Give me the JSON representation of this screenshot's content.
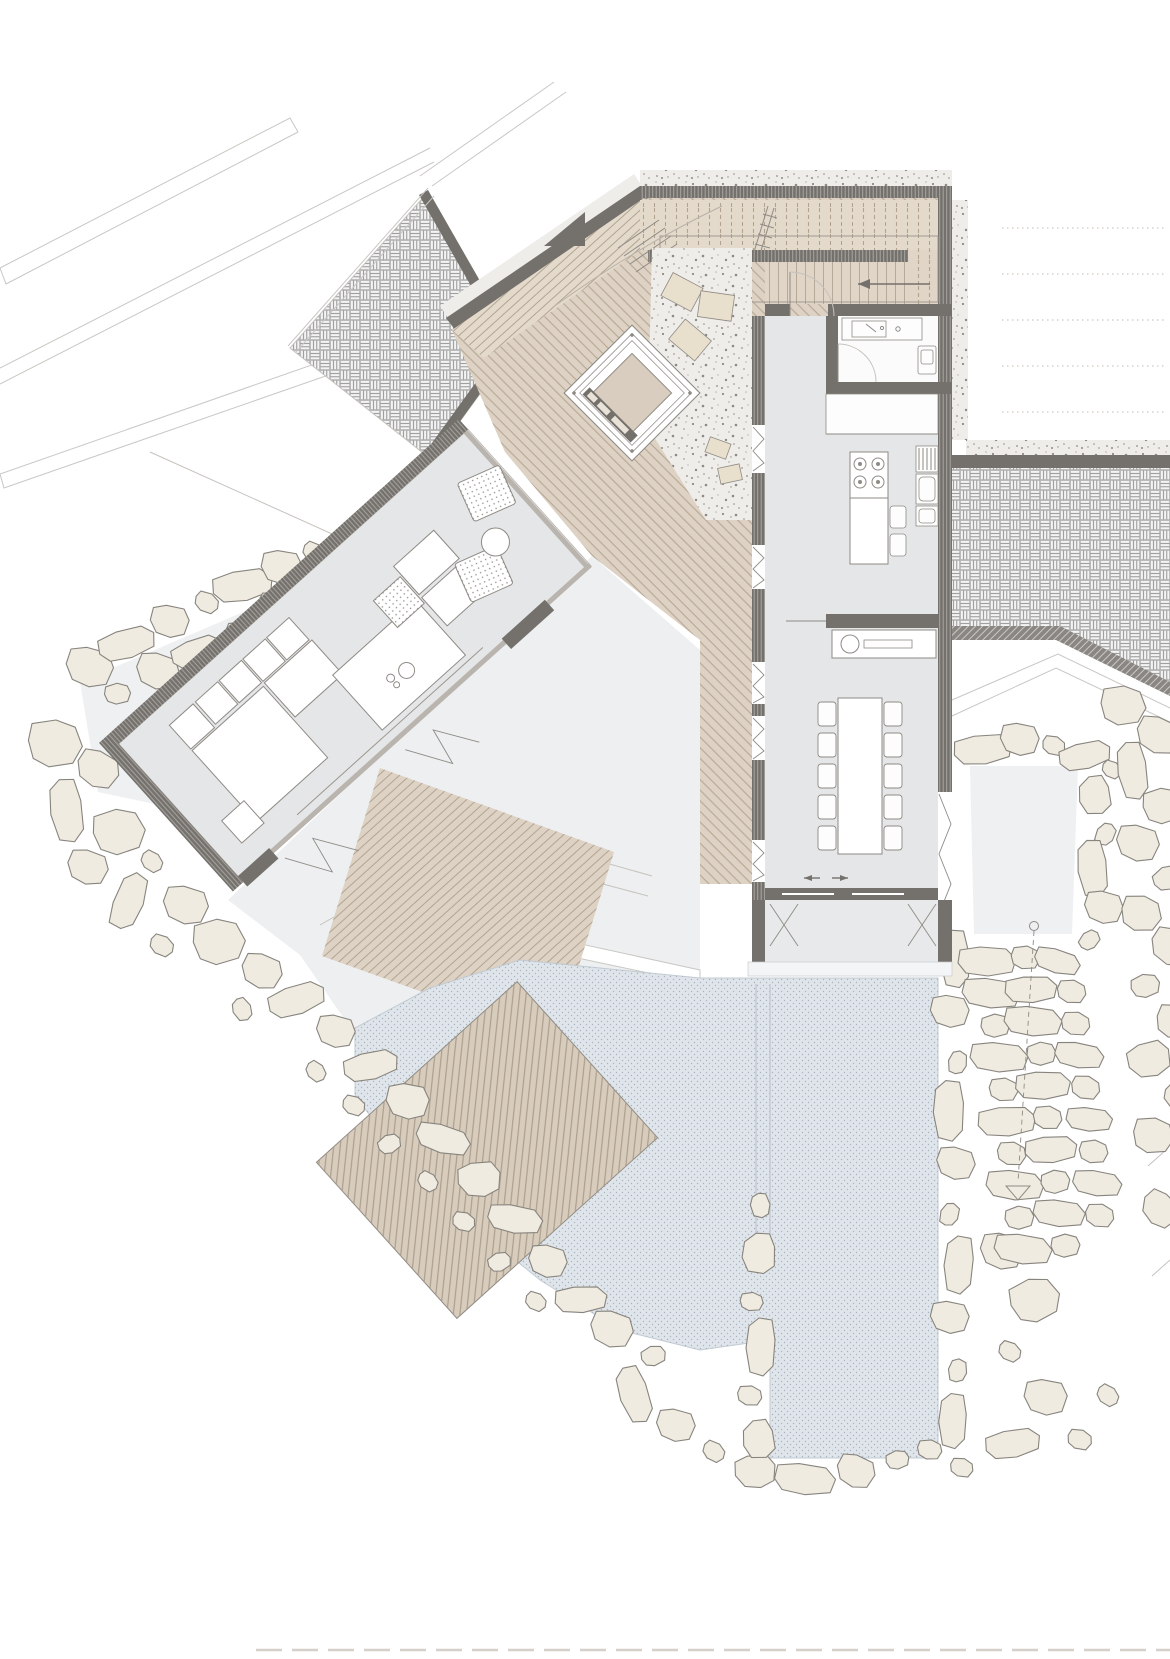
{
  "scene": {
    "type": "Architectural floor plan — hillside villa with two wings, fire-pit court, terraces and pool",
    "north_arrow": true,
    "areas": [
      "paved-court",
      "upper-court",
      "entry-deck",
      "stair-court",
      "bathroom",
      "kitchen",
      "dining-room",
      "living-room",
      "fire-pit-lounge",
      "gravel-court",
      "terrace",
      "garden-steps",
      "pool",
      "pool-deck",
      "stone-walls",
      "stone-terraces"
    ],
    "furniture_counts": {
      "dining_chairs": 10,
      "kitchen_stools": 2,
      "cooktop_burners": 4,
      "lounge_armchairs": 2,
      "stepping_stones": 3,
      "sofa_modules": 8
    }
  },
  "palette": {
    "wall": "#74706b",
    "wall2": "#8a8783",
    "line": "#8f8b85",
    "linefaint": "#c6c2bc",
    "floor": "#e5e6e7",
    "terrace": "#edeff1",
    "patio": "#eef0f2",
    "deck1": "#e4dacb",
    "deckline1": "#b3a38e",
    "deck2": "#ddd2c4",
    "deckline2": "#b2a492",
    "deck3": "#d8ccbd",
    "deckline3": "#a89a88",
    "stair": "#e0d5c6",
    "cushion": "#d8cdbf",
    "stepstone": "#e9dfcd",
    "gravelbg": "#efedea",
    "graveldot": "#8f8a82",
    "graveldot2": "#b8b3aa",
    "pool": "#dfe5ea",
    "pooldot": "#a6b4c0",
    "pooledge": "#c2cbd3",
    "stone": "#f0ebe0",
    "stoneedge": "#87847e",
    "basketbg": "#d9d9d9",
    "basketplank": "#f3f3f3",
    "basketline": "#9c9c9c",
    "path": "#c9c7c3",
    "pathdot": "#cfc8c0"
  }
}
